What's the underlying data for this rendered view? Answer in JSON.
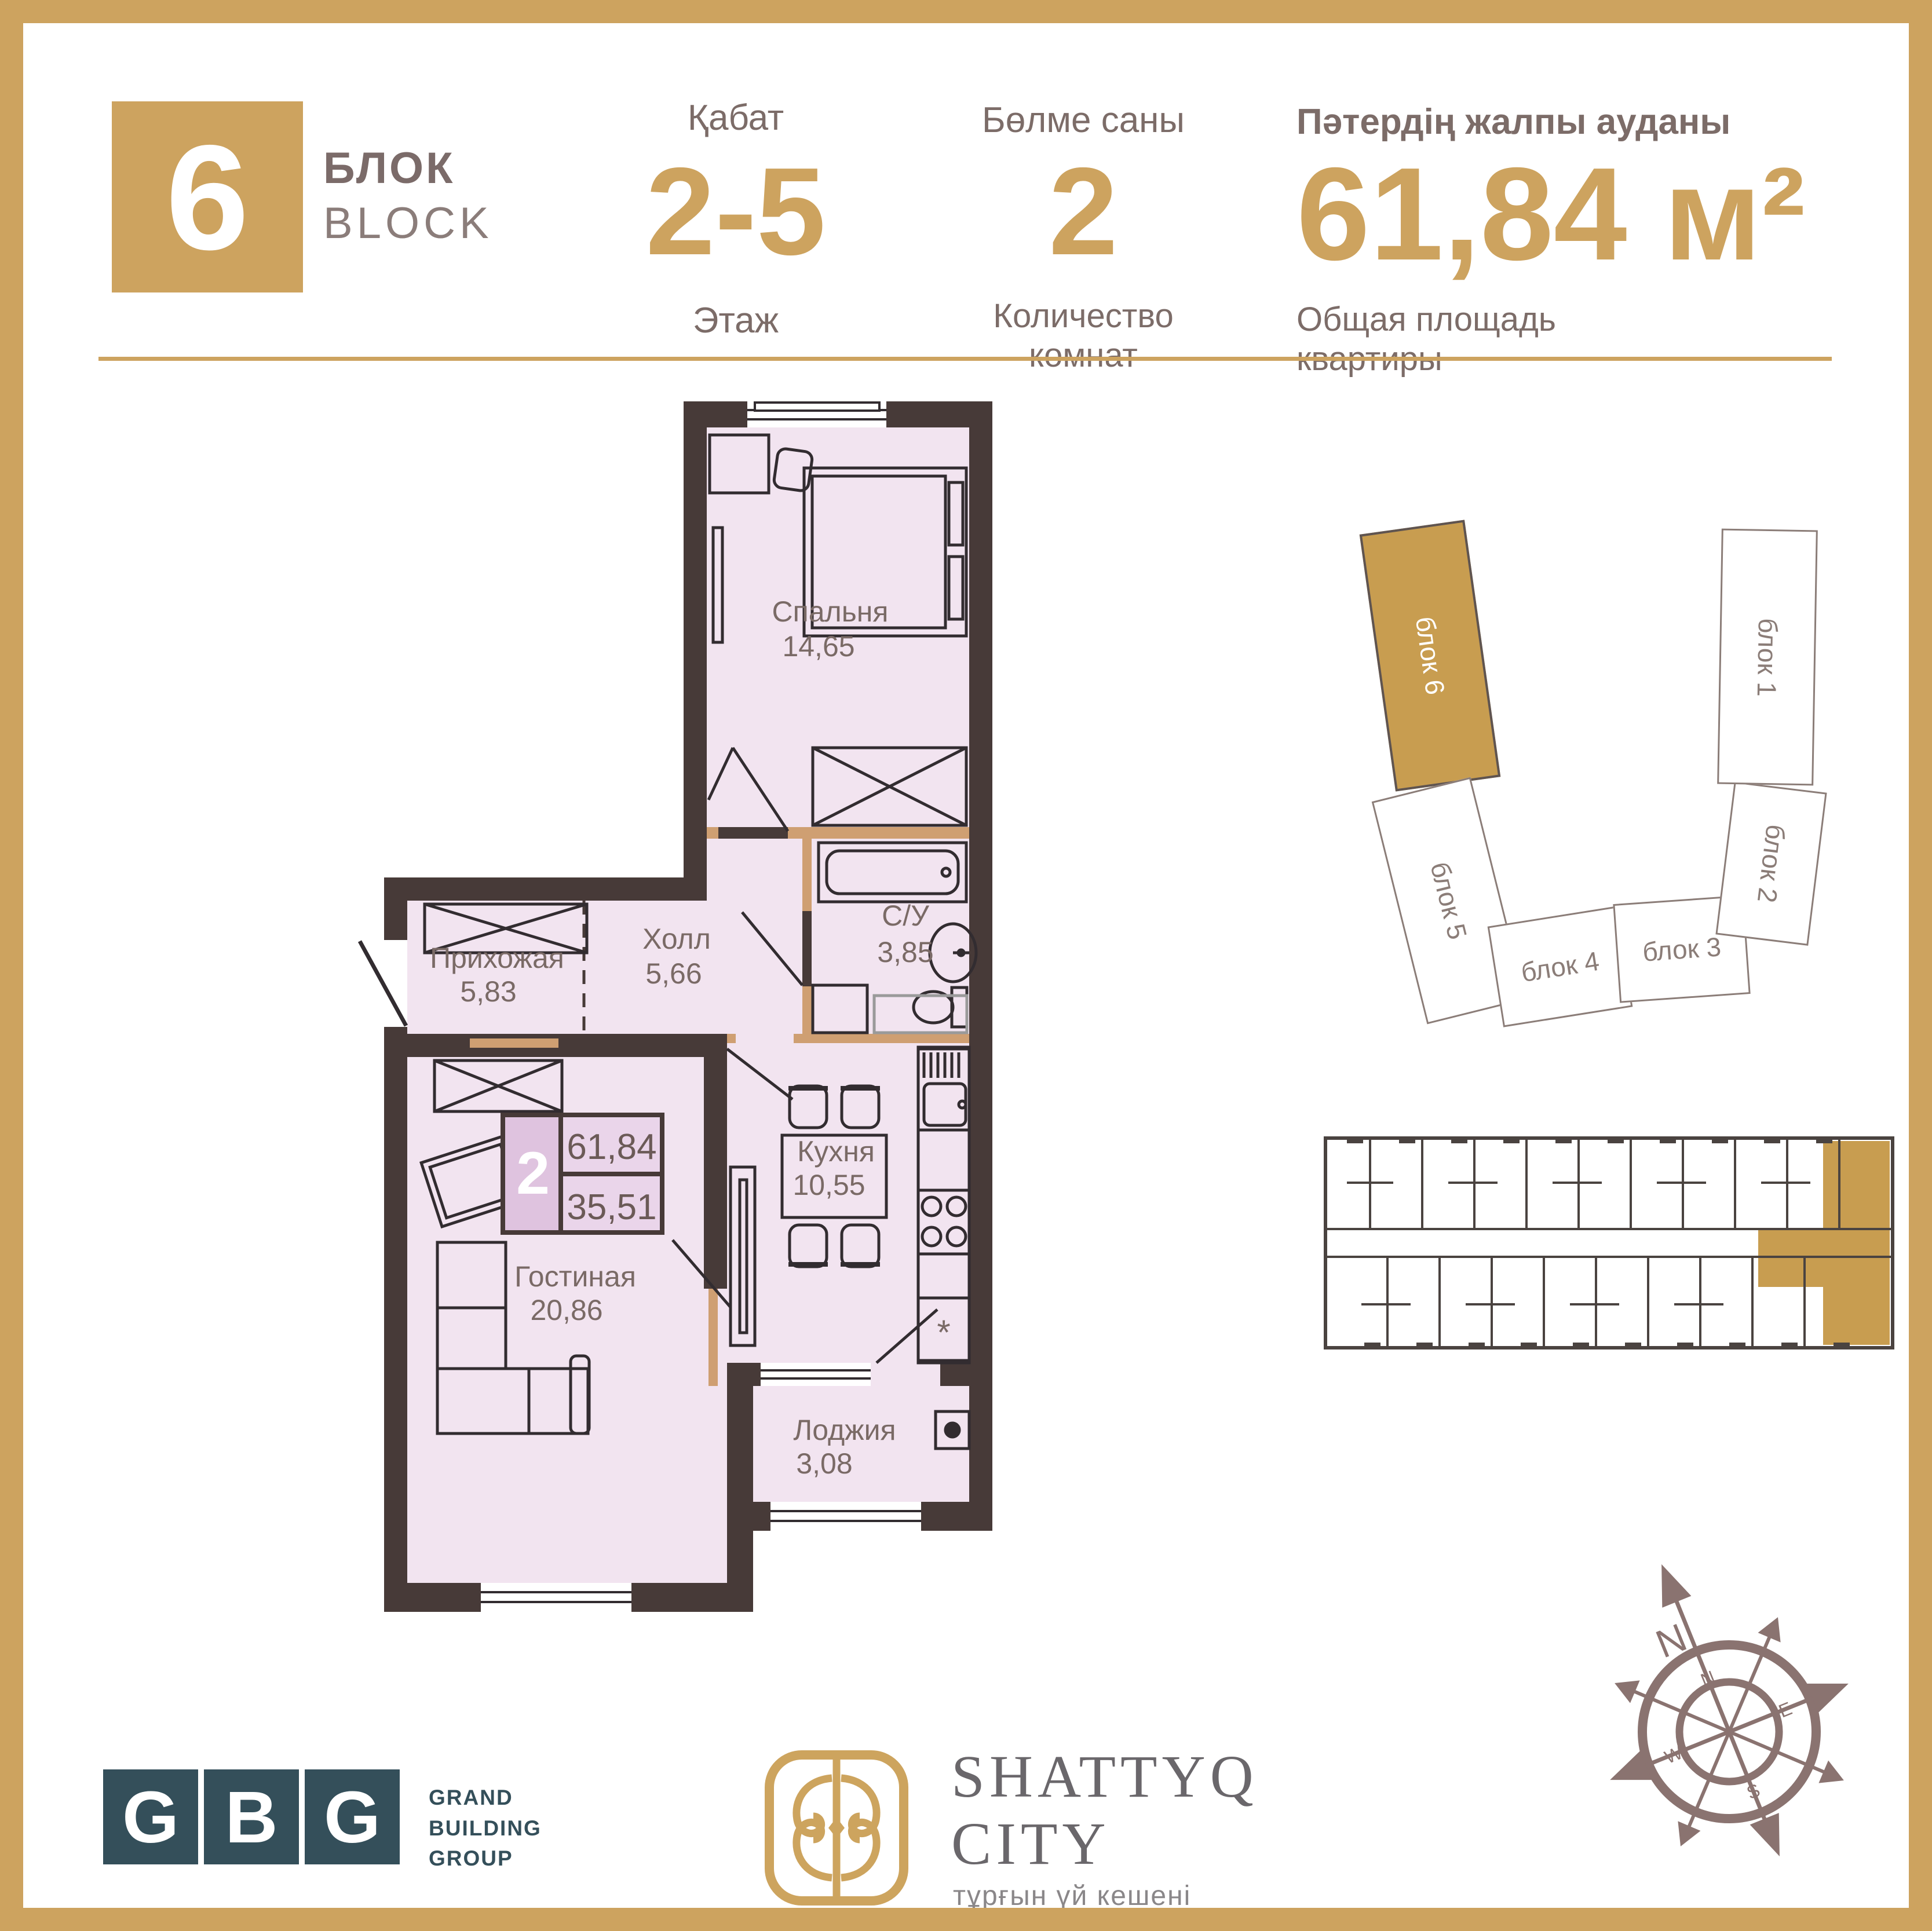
{
  "header": {
    "block_number": "6",
    "block_label_kk": "БЛОК",
    "block_label_en": "BLOCK",
    "floor": {
      "label_kk": "Қабат",
      "value": "2-5",
      "label_ru": "Этаж"
    },
    "rooms": {
      "label_kk": "Бөлме саны",
      "value": "2",
      "label_ru_line1": "Количество",
      "label_ru_line2": "комнат"
    },
    "area": {
      "label_kk": "Пәтердің жалпы ауданы",
      "value": "61,84 м²",
      "label_ru_line1": "Общая площадь",
      "label_ru_line2": "квартиры"
    }
  },
  "plan": {
    "rooms": [
      {
        "name": "Спальня",
        "area": "14,65"
      },
      {
        "name": "Холл",
        "area": "5,66"
      },
      {
        "name": "С/У",
        "area": "3,85"
      },
      {
        "name": "Прихожая",
        "area": "5,83"
      },
      {
        "name": "Кухня",
        "area": "10,55"
      },
      {
        "name": "Гостиная",
        "area": "20,86"
      },
      {
        "name": "Лоджия",
        "area": "3,08"
      }
    ],
    "badge": {
      "rooms": "2",
      "total_area": "61,84",
      "living_area": "35,51"
    },
    "fridge_mark": "*",
    "colors": {
      "wall": "#473a38",
      "floor": "#f2e4f0",
      "partition": "#cf9f72"
    }
  },
  "site_plan": {
    "blocks": [
      {
        "label": "блок 6",
        "highlighted": true
      },
      {
        "label": "блок 5",
        "highlighted": false
      },
      {
        "label": "блок 4",
        "highlighted": false
      },
      {
        "label": "блок 3",
        "highlighted": false
      },
      {
        "label": "блок 2",
        "highlighted": false
      },
      {
        "label": "блок 1",
        "highlighted": false
      }
    ]
  },
  "compass": {
    "north": "N",
    "dial": [
      "N",
      "E",
      "S",
      "W"
    ]
  },
  "footer": {
    "gbg": {
      "letters": [
        "G",
        "B",
        "G"
      ],
      "name_lines": [
        "GRAND",
        "BUILDING",
        "GROUP"
      ]
    },
    "shattyq": {
      "title_line1": "SHATTYQ",
      "title_line2": "CITY",
      "subtitle": "тұрғын үй кешені"
    }
  }
}
